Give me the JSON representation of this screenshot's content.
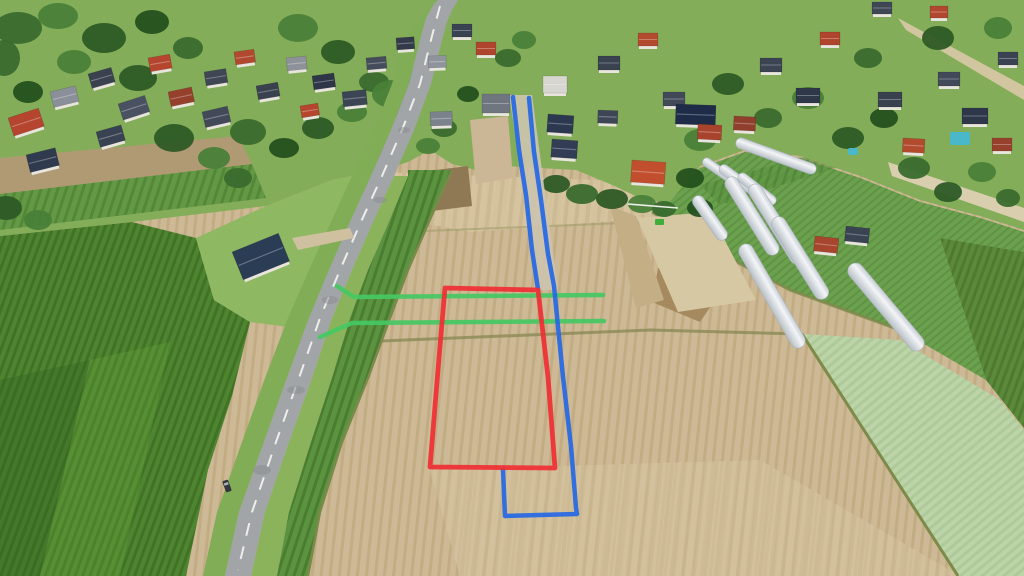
{
  "scene": {
    "alt": "Aerial drone photo of farmland plots beside a rural road and village, with a red plot-boundary outline, blue access-route lines and green utility lines drawn over the fields",
    "annotation_colors": {
      "plot_boundary": "#ef2f34",
      "access_route": "#2668e4",
      "utility_line": "#46c863"
    },
    "annotations": [
      {
        "id": "utility-line-north",
        "color": "#46c863",
        "width": 4.5,
        "closed": false,
        "points": [
          [
            337,
            286
          ],
          [
            354,
            297
          ],
          [
            603,
            295
          ]
        ]
      },
      {
        "id": "utility-line-south",
        "color": "#46c863",
        "width": 4.5,
        "closed": false,
        "points": [
          [
            320,
            337
          ],
          [
            352,
            323
          ],
          [
            604,
            321
          ]
        ]
      },
      {
        "id": "access-lane-west-edge",
        "color": "#2668e4",
        "width": 4.5,
        "closed": false,
        "points": [
          [
            513,
            97
          ],
          [
            519,
            150
          ],
          [
            526,
            195
          ],
          [
            532,
            250
          ],
          [
            538,
            289
          ]
        ]
      },
      {
        "id": "access-route-east-edge",
        "color": "#2668e4",
        "width": 4.5,
        "closed": false,
        "points": [
          [
            529,
            98
          ],
          [
            534,
            152
          ],
          [
            541,
            200
          ],
          [
            548,
            254
          ],
          [
            554,
            286
          ],
          [
            563,
            377
          ],
          [
            571,
            446
          ],
          [
            576,
            508
          ],
          [
            577,
            514
          ],
          [
            505,
            516
          ],
          [
            503,
            470
          ]
        ]
      },
      {
        "id": "plot-boundary",
        "color": "#ef2f34",
        "width": 4.8,
        "closed": true,
        "points": [
          [
            445,
            288
          ],
          [
            538,
            290
          ],
          [
            548,
            377
          ],
          [
            555,
            468
          ],
          [
            430,
            467
          ],
          [
            438,
            370
          ]
        ]
      }
    ],
    "tree_palette": [
      "#2d5a26",
      "#3a6b2e",
      "#497f38",
      "#24511e",
      "#578f3f"
    ],
    "trees": [
      [
        18,
        28,
        24,
        16,
        1
      ],
      [
        58,
        16,
        20,
        13,
        2
      ],
      [
        104,
        38,
        22,
        15,
        0
      ],
      [
        152,
        22,
        17,
        12,
        3
      ],
      [
        188,
        48,
        15,
        11,
        1
      ],
      [
        74,
        62,
        17,
        12,
        2
      ],
      [
        138,
        78,
        19,
        13,
        0
      ],
      [
        28,
        92,
        15,
        11,
        3
      ],
      [
        4,
        58,
        16,
        18,
        1
      ],
      [
        174,
        138,
        20,
        14,
        0
      ],
      [
        214,
        158,
        16,
        11,
        2
      ],
      [
        248,
        132,
        18,
        13,
        1
      ],
      [
        284,
        148,
        15,
        10,
        3
      ],
      [
        318,
        128,
        16,
        11,
        0
      ],
      [
        352,
        112,
        15,
        10,
        2
      ],
      [
        238,
        178,
        14,
        10,
        1
      ],
      [
        298,
        28,
        20,
        14,
        2
      ],
      [
        338,
        52,
        17,
        12,
        0
      ],
      [
        374,
        82,
        15,
        10,
        1
      ],
      [
        418,
        78,
        13,
        9,
        3
      ],
      [
        398,
        108,
        13,
        9,
        0
      ],
      [
        392,
        94,
        20,
        14,
        2
      ],
      [
        444,
        128,
        13,
        9,
        1
      ],
      [
        468,
        94,
        11,
        8,
        3
      ],
      [
        508,
        58,
        13,
        9,
        1
      ],
      [
        524,
        40,
        12,
        9,
        2
      ],
      [
        556,
        184,
        14,
        9,
        0
      ],
      [
        582,
        194,
        16,
        10,
        1
      ],
      [
        612,
        199,
        16,
        10,
        0
      ],
      [
        642,
        204,
        14,
        9,
        2
      ],
      [
        664,
        209,
        12,
        8,
        1
      ],
      [
        690,
        178,
        14,
        10,
        3
      ],
      [
        700,
        140,
        16,
        11,
        2
      ],
      [
        728,
        84,
        16,
        11,
        0
      ],
      [
        768,
        118,
        14,
        10,
        1
      ],
      [
        808,
        98,
        16,
        11,
        2
      ],
      [
        848,
        138,
        16,
        11,
        0
      ],
      [
        884,
        118,
        14,
        10,
        3
      ],
      [
        914,
        168,
        16,
        11,
        1
      ],
      [
        948,
        192,
        14,
        10,
        0
      ],
      [
        982,
        172,
        14,
        10,
        2
      ],
      [
        1008,
        198,
        12,
        9,
        1
      ],
      [
        938,
        38,
        16,
        12,
        0
      ],
      [
        998,
        28,
        14,
        11,
        2
      ],
      [
        868,
        58,
        14,
        10,
        1
      ],
      [
        6,
        208,
        16,
        12,
        0
      ],
      [
        38,
        220,
        14,
        10,
        2
      ],
      [
        388,
        156,
        13,
        9,
        1
      ],
      [
        428,
        146,
        12,
        8,
        2
      ],
      [
        700,
        208,
        13,
        9,
        3
      ]
    ],
    "houses": [
      [
        8,
        118,
        32,
        19,
        -18,
        "#b5452e"
      ],
      [
        50,
        92,
        26,
        16,
        -14,
        "#8a8f99"
      ],
      [
        88,
        74,
        24,
        15,
        -16,
        "#3a4250"
      ],
      [
        118,
        104,
        28,
        17,
        -18,
        "#4a5262"
      ],
      [
        148,
        58,
        22,
        14,
        -10,
        "#b5452e"
      ],
      [
        26,
        155,
        30,
        18,
        -14,
        "#2f3a4e"
      ],
      [
        96,
        132,
        26,
        16,
        -16,
        "#394252"
      ],
      [
        168,
        92,
        24,
        15,
        -12,
        "#95402c"
      ],
      [
        204,
        72,
        22,
        14,
        -9,
        "#3f4754"
      ],
      [
        234,
        52,
        20,
        13,
        -8,
        "#b0492f"
      ],
      [
        202,
        112,
        26,
        16,
        -13,
        "#424a5a"
      ],
      [
        256,
        86,
        22,
        14,
        -10,
        "#39414f"
      ],
      [
        286,
        58,
        20,
        13,
        -6,
        "#8d9199"
      ],
      [
        312,
        76,
        22,
        14,
        -8,
        "#2e3648"
      ],
      [
        342,
        92,
        24,
        15,
        -6,
        "#3c4554"
      ],
      [
        300,
        106,
        18,
        12,
        -9,
        "#b5452e"
      ],
      [
        366,
        58,
        20,
        12,
        -5,
        "#454d5c"
      ],
      [
        396,
        38,
        18,
        12,
        -4,
        "#333b4a"
      ],
      [
        428,
        56,
        18,
        12,
        -2,
        "#8f939b"
      ],
      [
        452,
        24,
        20,
        13,
        0,
        "#3a4352"
      ],
      [
        476,
        42,
        20,
        13,
        0,
        "#b0452d"
      ],
      [
        482,
        94,
        28,
        19,
        0,
        "#70767f"
      ],
      [
        430,
        112,
        22,
        14,
        -2,
        "#7c828c"
      ],
      [
        543,
        76,
        24,
        17,
        0,
        "#d7d6d0"
      ],
      [
        548,
        114,
        26,
        18,
        4,
        "#2c3850"
      ],
      [
        552,
        139,
        26,
        18,
        4,
        "#323c55"
      ],
      [
        598,
        110,
        20,
        13,
        2,
        "#3e4656"
      ],
      [
        632,
        160,
        34,
        22,
        4,
        "#c14f2e"
      ],
      [
        598,
        56,
        22,
        14,
        0,
        "#39424f"
      ],
      [
        638,
        33,
        20,
        13,
        0,
        "#b24b2e"
      ],
      [
        663,
        92,
        22,
        14,
        0,
        "#414958"
      ],
      [
        676,
        104,
        40,
        20,
        2,
        "#1e2c48"
      ],
      [
        698,
        124,
        24,
        15,
        3,
        "#a8432d"
      ],
      [
        734,
        116,
        22,
        14,
        3,
        "#8f3f2b"
      ],
      [
        760,
        58,
        22,
        14,
        0,
        "#3c4453"
      ],
      [
        796,
        88,
        24,
        15,
        0,
        "#2f3848"
      ],
      [
        820,
        32,
        20,
        13,
        0,
        "#b0452d"
      ],
      [
        815,
        236,
        24,
        15,
        6,
        "#a8452e"
      ],
      [
        846,
        226,
        24,
        15,
        6,
        "#3a4352"
      ],
      [
        878,
        92,
        24,
        15,
        0,
        "#39414f"
      ],
      [
        903,
        138,
        22,
        14,
        3,
        "#b24a2e"
      ],
      [
        938,
        72,
        22,
        14,
        0,
        "#424a59"
      ],
      [
        962,
        108,
        26,
        16,
        0,
        "#2e374a"
      ],
      [
        992,
        138,
        20,
        13,
        0,
        "#97412c"
      ],
      [
        998,
        52,
        20,
        13,
        0,
        "#3b4352"
      ],
      [
        872,
        2,
        20,
        12,
        0,
        "#3f4755"
      ],
      [
        930,
        6,
        18,
        12,
        0,
        "#b0472e"
      ],
      [
        232,
        252,
        50,
        30,
        -22,
        "#2b3c55"
      ]
    ],
    "polytunnels": [
      [
        718,
        170,
        36,
        9,
        35
      ],
      [
        737,
        179,
        42,
        10,
        36
      ],
      [
        757,
        189,
        46,
        10,
        38
      ],
      [
        776,
        156,
        85,
        11,
        20
      ],
      [
        710,
        218,
        52,
        12,
        55
      ],
      [
        752,
        216,
        90,
        14,
        58
      ],
      [
        776,
        224,
        92,
        14,
        58
      ],
      [
        800,
        258,
        95,
        15,
        58
      ],
      [
        772,
        296,
        118,
        15,
        60
      ],
      [
        886,
        307,
        110,
        16,
        50
      ]
    ],
    "pools": [
      [
        950,
        132,
        20,
        13
      ],
      [
        848,
        148,
        10,
        7
      ]
    ],
    "car": [
      227,
      486,
      -20
    ],
    "tractor": [
      655,
      219
    ]
  }
}
